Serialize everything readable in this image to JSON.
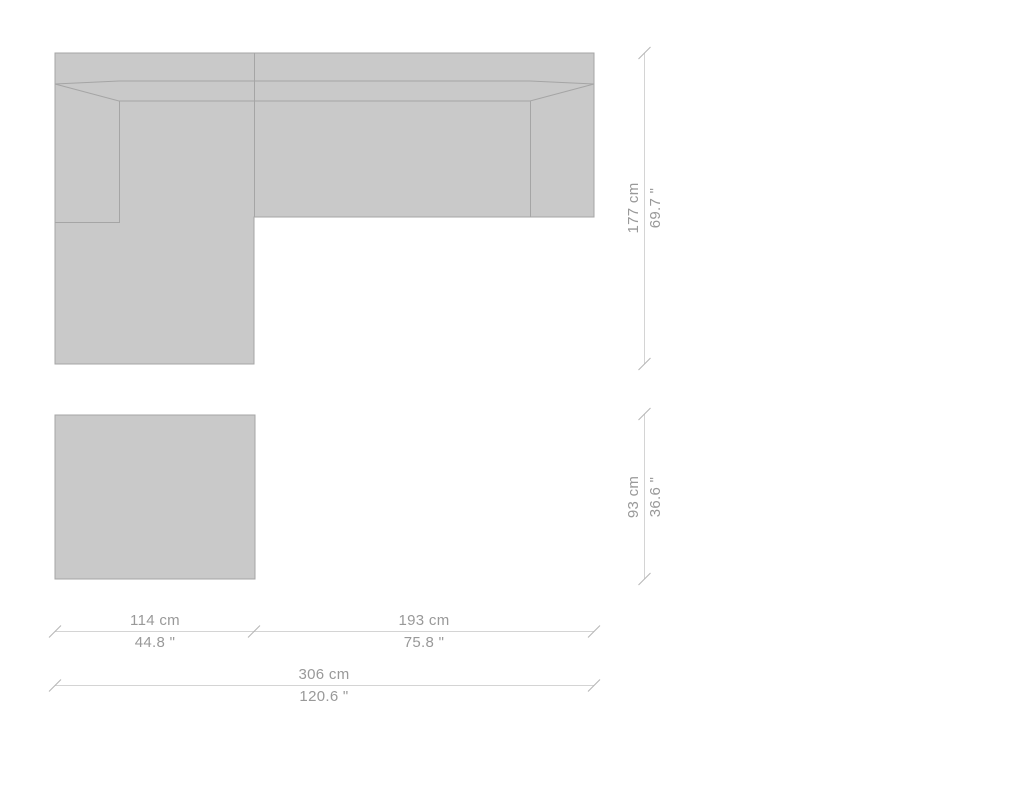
{
  "colors": {
    "background": "#ffffff",
    "furniture_fill": "#c9c9c9",
    "furniture_outline": "#a5a5a5",
    "dimension_line": "#d4d4d4",
    "dimension_tick": "#b5b5b5",
    "dimension_text": "#999999"
  },
  "diagram": {
    "type": "corner-sofa-with-ottoman-top-view-dimension-drawing",
    "dimensions": {
      "sofa_depth": {
        "cm": "177 cm",
        "inches": "69.7 \""
      },
      "ottoman_depth": {
        "cm": "93 cm",
        "inches": "36.6 \""
      },
      "chaise_width": {
        "cm": "114 cm",
        "inches": "44.8 \""
      },
      "sofa_body_width": {
        "cm": "193 cm",
        "inches": "75.8 \""
      },
      "total_width": {
        "cm": "306 cm",
        "inches": "120.6 \""
      }
    }
  }
}
